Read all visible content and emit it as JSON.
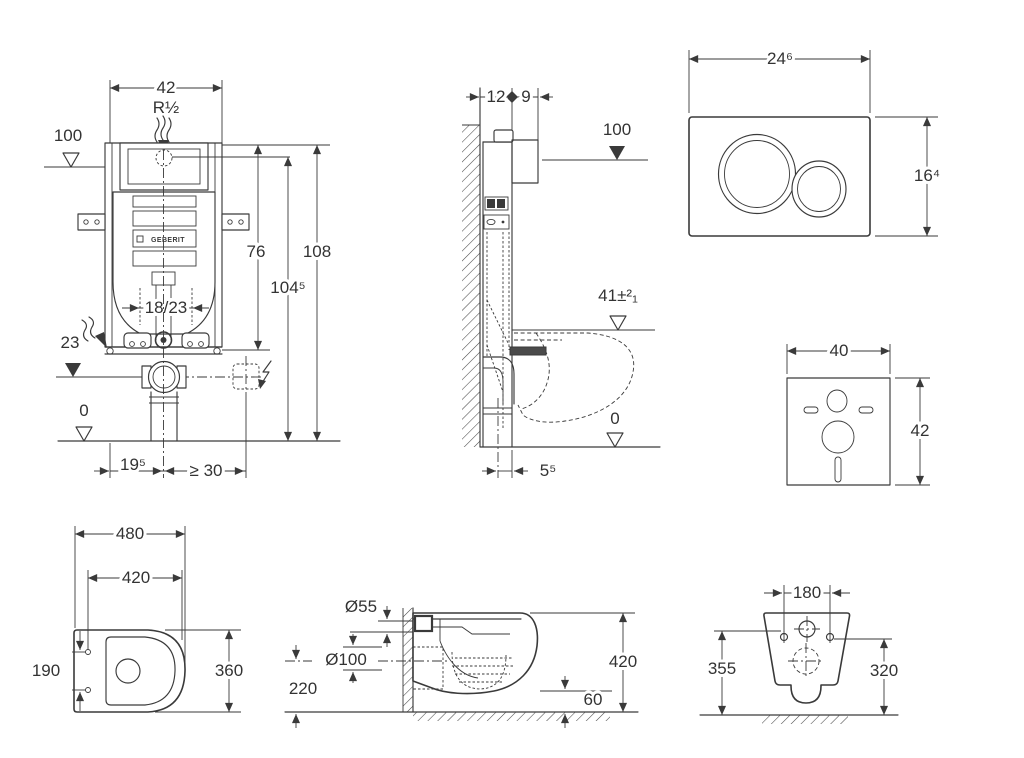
{
  "page": {
    "title": "Wall-hung WC with concealed cistern — installation dimensions",
    "background": "#ffffff",
    "ink": "#3a3a3a"
  },
  "views": {
    "frame_front": {
      "name": "concealed-cistern-frame-front-view",
      "brand": "GEBERIT",
      "dims": {
        "d42": "42",
        "thread": "R½",
        "level100": "100",
        "d76": "76",
        "d108": "108",
        "d104_5": "104⁵",
        "d18_23": "18/23",
        "d23": "23",
        "level0": "0",
        "d19_5": "19⁵",
        "d30": "≥ 30"
      }
    },
    "frame_side": {
      "name": "concealed-cistern-frame-side-view",
      "dims": {
        "d12": "12",
        "d9": "9",
        "level100": "100",
        "rim": "41±²₁",
        "level0": "0",
        "d5_5": "5⁵"
      }
    },
    "flush_plate": {
      "name": "flush-plate-front-view",
      "dims": {
        "w": "24⁶",
        "h": "16⁴"
      }
    },
    "sound_pad": {
      "name": "sound-insulation-pad",
      "dims": {
        "w": "40",
        "h": "42"
      }
    },
    "wc_top": {
      "name": "wc-pan-top-view",
      "dims": {
        "length": "480",
        "inner": "420",
        "holes": "190",
        "width": "360"
      }
    },
    "wc_side": {
      "name": "wc-pan-side-view",
      "dims": {
        "flush": "Ø55",
        "drain": "Ø100",
        "drain_h": "220",
        "height": "420",
        "clearance": "60"
      }
    },
    "wc_rear": {
      "name": "wc-pan-rear-view",
      "dims": {
        "holes": "180",
        "left_h": "355",
        "right_h": "320"
      }
    }
  }
}
